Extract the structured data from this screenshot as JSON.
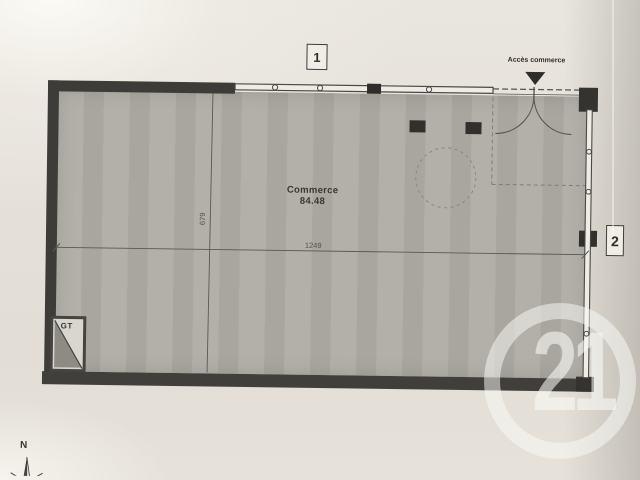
{
  "plan": {
    "room": {
      "name": "Commerce",
      "area": "84.48"
    },
    "dimensions": {
      "width": "1249",
      "depth": "679"
    },
    "markers": {
      "top": "1",
      "right": "2"
    },
    "entrance": {
      "label": "Accès commerce"
    },
    "utility": {
      "label": "GT"
    },
    "compass": {
      "north": "N"
    }
  },
  "watermark": {
    "number": "21"
  },
  "colors": {
    "paper": "#e5e1d9",
    "floor": "#b0ada6",
    "wall": "#3d3c38",
    "linework": "#55544f",
    "watermark": "#faf9f6"
  }
}
